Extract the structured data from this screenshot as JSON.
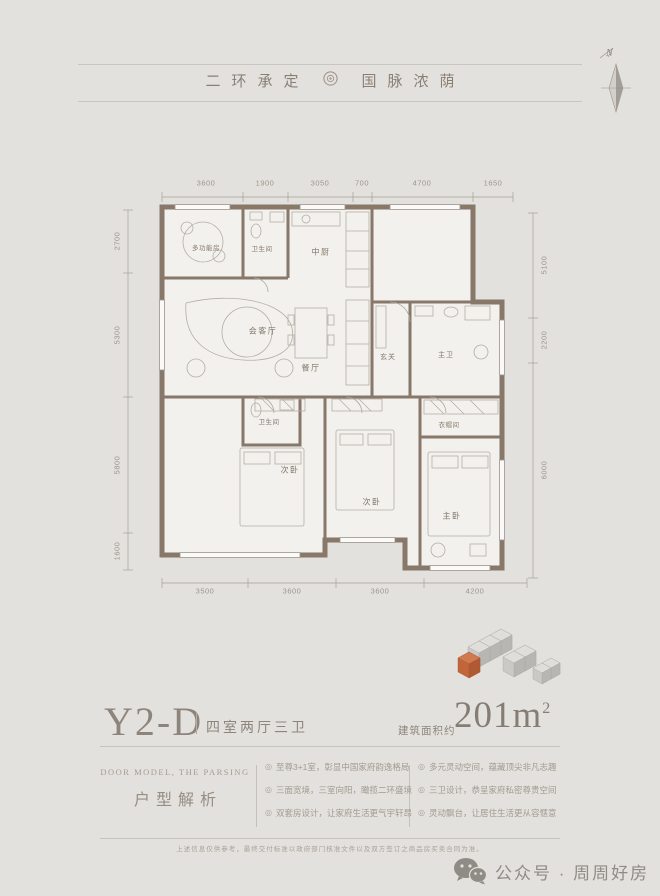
{
  "header": {
    "slogan_left": "二环承定",
    "slogan_right": "国脉浓荫"
  },
  "compass": {
    "north_label": "N"
  },
  "floor_plan": {
    "rooms": {
      "multi_function": "多功能房",
      "bathroom_top": "卫生间",
      "kitchen": "中厨",
      "living": "会客厅",
      "dining": "餐厅",
      "foyer": "玄关",
      "master_bath": "主卫",
      "cloakroom": "衣帽间",
      "bathroom_mid": "卫生间",
      "bedroom_2": "次卧",
      "bedroom_3": "次卧",
      "master_bedroom": "主卧"
    },
    "dims_top": [
      "3600",
      "1900",
      "3050",
      "700",
      "4700",
      "1650"
    ],
    "dims_bottom": [
      "3500",
      "3600",
      "3600",
      "4200"
    ],
    "dims_left": [
      "2700",
      "5300",
      "5800",
      "1600"
    ],
    "dims_right": [
      "5100",
      "2200",
      "6000"
    ]
  },
  "unit": {
    "code": "Y2-D",
    "layout": "四室两厅三卫",
    "area_prefix": "建筑面积约",
    "area_value": "201m",
    "area_sup": "2"
  },
  "analysis": {
    "title_en": "DOOR MODEL, THE PARSING",
    "title_cn": "户型解析",
    "bullet": "◎",
    "col1": [
      "至尊3+1室，彰显中国家府韵逸格局",
      "三面宽境，三室向阳，瞰揽二环盛境",
      "双套房设计，让家府生活更气宇轩昂"
    ],
    "col2": [
      "多元灵动空间，蕴藏顶尖非凡志趣",
      "三卫设计，恭呈家府私密尊贵空间",
      "灵动飘台，让居住生活更从容惬意"
    ]
  },
  "footer": {
    "disclaimer": "上述信息仅供参考，最终交付标准以政府部门核准文件以及双方签订之商品房买卖合同为准。",
    "wechat_label": "公众号 · 周周好房"
  },
  "colors": {
    "background": "#e3e1dd",
    "wall": "#87786a",
    "accent_orange": "#c2653d",
    "text": "#8a8177"
  }
}
